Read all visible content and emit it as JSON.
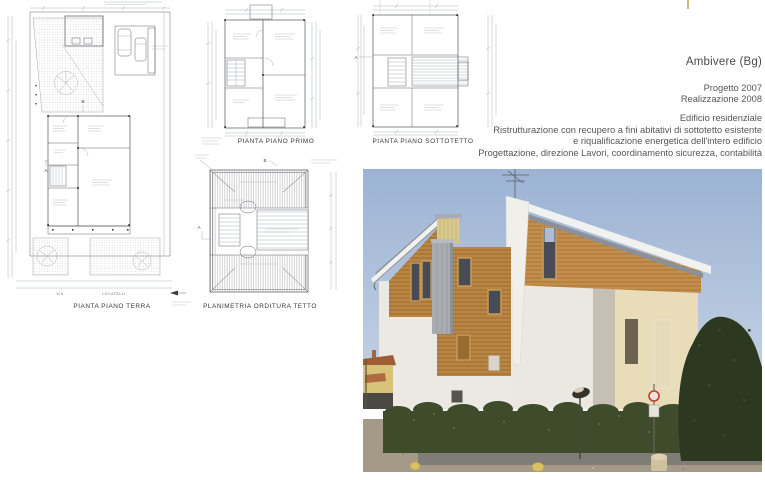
{
  "header": {
    "location": "Ambivere (Bg)",
    "project_year": "Progetto 2007",
    "realization_year": "Realizzazione 2008",
    "description_lines": [
      "Edificio residenziale",
      "Ristrutturazione con recupero a fini abitativi di sottotetto esistente",
      "e riqualificazione energetica dell'intero edificio",
      "Progettazione, direzione Lavori, coordinamento sicurezza, contabilità"
    ]
  },
  "drawings": {
    "plans": [
      {
        "title": "PIANTA PIANO TERRA"
      },
      {
        "title": "PIANTA PIANO PRIMO"
      },
      {
        "title": "PIANTA PIANO SOTTOTETTO"
      },
      {
        "title": "PLANIMETRIA ORDITURA TETTO"
      }
    ],
    "street_name_1": "VIA",
    "street_name_2": "LOCATELLI",
    "section_marker_a": "A",
    "section_marker_b": "B",
    "line_color": "#55565a"
  },
  "photo": {
    "colors": {
      "sky": "#a9bedb",
      "wood_cladding": "#b5813f",
      "plaster": "#eae8e1",
      "roof_metal": "#9aa0a6",
      "gable_panel": "#d9c98e",
      "hedge": "#3f4c2c",
      "tree": "#2c381f",
      "road": "#a59a88"
    }
  }
}
